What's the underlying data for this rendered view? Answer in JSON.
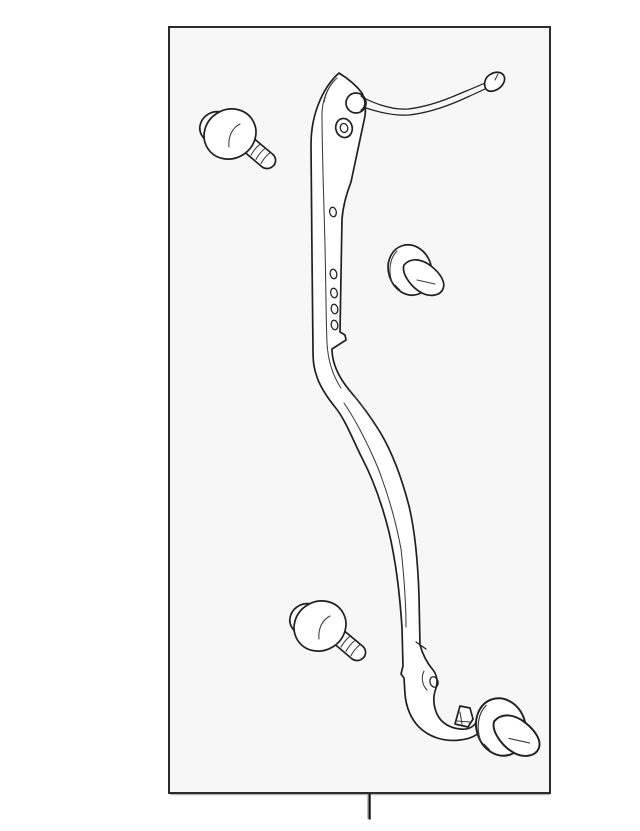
{
  "figure": {
    "name": "exploded-parts-line-diagram",
    "frame": {
      "background": "#f7f7f7",
      "border_color": "#2b2b2b",
      "shadow_color": "#b5b5b5"
    },
    "palette": {
      "line": "#202020",
      "part_fill": "#ffffff",
      "page_background": "#ffffff",
      "tick": "#111111"
    },
    "parts": [
      {
        "name": "wire-mounting-bracket"
      },
      {
        "name": "tapping-screw-upper-left"
      },
      {
        "name": "tapping-screw-lower-left"
      },
      {
        "name": "push-clip-middle-right"
      },
      {
        "name": "push-clip-lower-right"
      }
    ],
    "callout_tick": {
      "name": "bottom-center-callout-tick"
    }
  }
}
